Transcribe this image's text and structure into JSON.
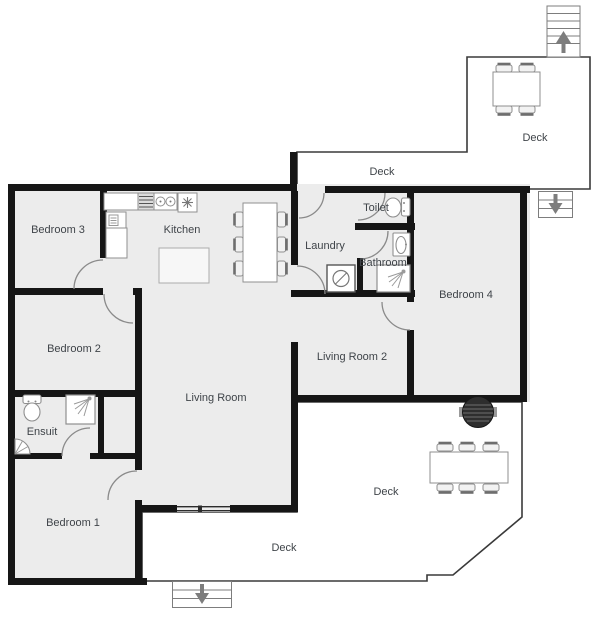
{
  "plan": {
    "title": "House floor plan",
    "room_labels": [
      {
        "id": "bedroom-3",
        "label": "Bedroom 3"
      },
      {
        "id": "kitchen",
        "label": "Kitchen"
      },
      {
        "id": "laundry",
        "label": "Laundry"
      },
      {
        "id": "toilet",
        "label": "Toilet"
      },
      {
        "id": "bathroom",
        "label": "Bathroom"
      },
      {
        "id": "bedroom-4",
        "label": "Bedroom 4"
      },
      {
        "id": "bedroom-2",
        "label": "Bedroom 2"
      },
      {
        "id": "living-room",
        "label": "Living Room"
      },
      {
        "id": "living-room-2",
        "label": "Living Room 2"
      },
      {
        "id": "ensuit",
        "label": "Ensuit"
      },
      {
        "id": "bedroom-1",
        "label": "Bedroom 1"
      },
      {
        "id": "deck-front-strip",
        "label": "Deck"
      },
      {
        "id": "deck-top-right",
        "label": "Deck"
      },
      {
        "id": "deck-rear-right",
        "label": "Deck"
      },
      {
        "id": "deck-rear-strip",
        "label": "Deck"
      }
    ],
    "fixtures": {
      "kitchen": [
        "counter",
        "stove",
        "double-sink",
        "cooktop",
        "dishwasher",
        "cabinet",
        "island",
        "dining-table-6-chairs"
      ],
      "laundry": [
        "washing-machine"
      ],
      "toilet": [
        "toilet"
      ],
      "bathroom": [
        "sink",
        "shower"
      ],
      "ensuit": [
        "toilet",
        "shower",
        "corner-sink"
      ],
      "decks": [
        "table-4-chairs",
        "table-6-chairs",
        "bbq-grill"
      ],
      "stairs": [
        {
          "location": "top-right",
          "direction": "up"
        },
        {
          "location": "right",
          "direction": "down"
        },
        {
          "location": "bottom",
          "direction": "down"
        }
      ]
    },
    "colors": {
      "wall": "#161616",
      "room_fill": "#ececec",
      "deck_fill": "#ffffff",
      "furniture_stroke": "#8f8f8f",
      "label_text": "#3f4449",
      "arrow": "#7d7d7d",
      "bbq": "#2e2e2e"
    }
  }
}
